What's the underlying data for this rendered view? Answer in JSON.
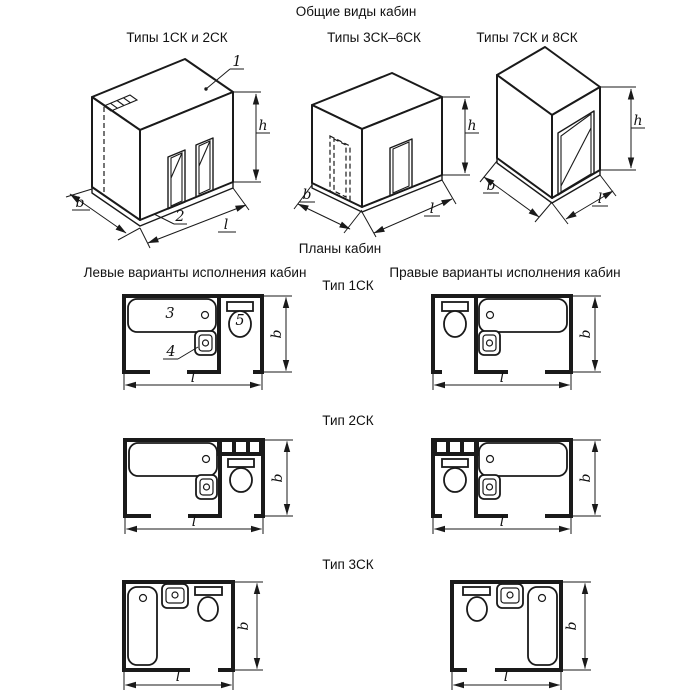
{
  "colors": {
    "line": "#1a1a1a",
    "background": "#ffffff"
  },
  "general_views": {
    "title": "Общие виды кабин",
    "types": [
      {
        "label": "Типы 1СК и 2СК"
      },
      {
        "label": "Типы 3СК–6СК"
      },
      {
        "label": "Типы 7СК и 8СК"
      }
    ],
    "callouts": {
      "roof_panel": "1",
      "floor_panel": "2"
    },
    "dims": {
      "depth": "b",
      "length": "l",
      "height": "h"
    }
  },
  "plans": {
    "title": "Планы кабин",
    "left_heading": "Левые варианты исполнения кабин",
    "right_heading": "Правые варианты исполнения кабин",
    "types": [
      {
        "label": "Тип 1СК"
      },
      {
        "label": "Тип 2СК"
      },
      {
        "label": "Тип 3СК"
      }
    ],
    "callouts": {
      "bath": "3",
      "washbasin": "4",
      "toilet": "5"
    },
    "dims": {
      "depth": "b",
      "length": "l"
    }
  }
}
